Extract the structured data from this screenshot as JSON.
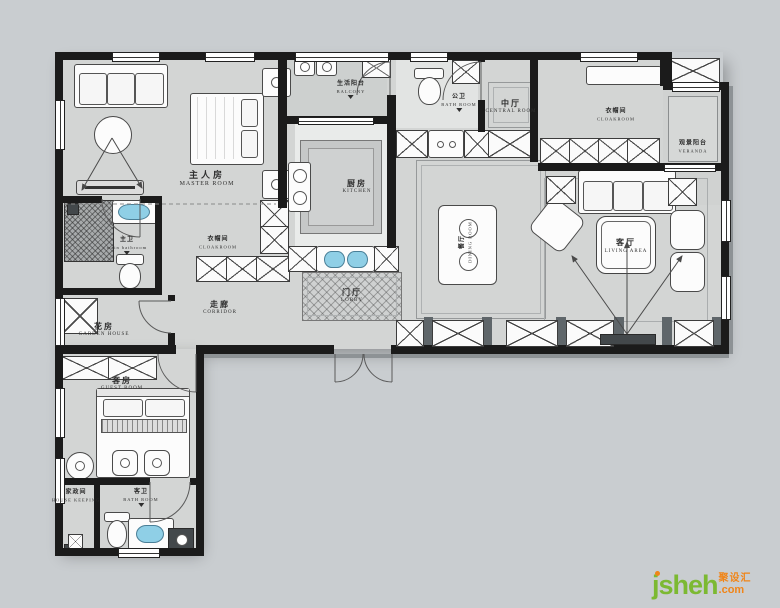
{
  "page": {
    "background": "#c9cdd0",
    "floor": "#d3d5d4",
    "wall": "#1b1b1b",
    "accent_blue": "#8fcfe6"
  },
  "watermark": {
    "brand": "jsheh",
    "tld": ".com",
    "brand_cn": "聚设汇",
    "green": "#7cb932",
    "orange": "#f08519"
  },
  "rooms": {
    "master": {
      "cn": "主人房",
      "en": "MASTER ROOM"
    },
    "master_cloak": {
      "cn": "衣帽间",
      "en": "CLOAKROOM"
    },
    "master_bath": {
      "cn": "主卫",
      "en": "main bathroom"
    },
    "garden": {
      "cn": "花房",
      "en": "GARDEN HOUSE"
    },
    "corridor": {
      "cn": "走廊",
      "en": "CORRIDOR"
    },
    "lobby": {
      "cn": "门厅",
      "en": "LOBBY"
    },
    "kitchen": {
      "cn": "厨房",
      "en": "KITCHEN"
    },
    "balcony": {
      "cn": "生活阳台",
      "en": "BALCONY"
    },
    "bath_public": {
      "cn": "公卫",
      "en": "BATH ROOM"
    },
    "central": {
      "cn": "中厅",
      "en": "CENTRAL ROOM"
    },
    "cloak2": {
      "cn": "衣帽间",
      "en": "CLOAKROOM"
    },
    "veranda": {
      "cn": "观景阳台",
      "en": "VERANDA"
    },
    "dining": {
      "cn": "餐厅",
      "en": "DINING ROOM"
    },
    "living": {
      "cn": "客厅",
      "en": "LIVING AREA"
    },
    "guest": {
      "cn": "客房",
      "en": "GUEST ROOM"
    },
    "guest_bath": {
      "cn": "客卫",
      "en": "BATH ROOM"
    },
    "laundry": {
      "cn": "家政间",
      "en": "HOUSE KEEPING"
    }
  }
}
